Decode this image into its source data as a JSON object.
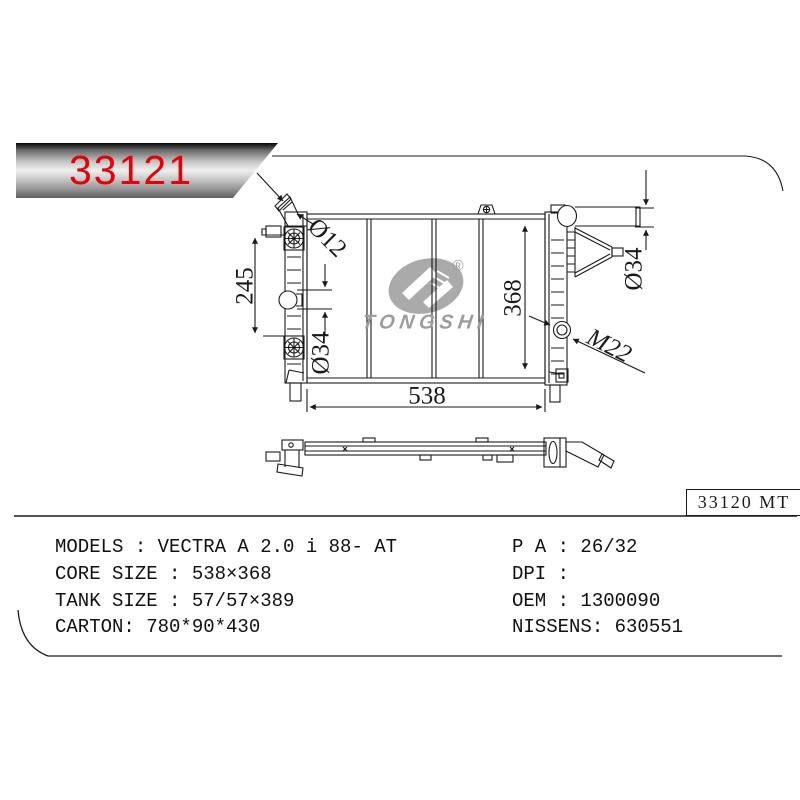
{
  "banner": {
    "part_number": "33121"
  },
  "watermark": {
    "brand": "TONGSHI",
    "registered": "®"
  },
  "drawing": {
    "labels": {
      "left_span": "245",
      "inlet_diameter": "Ø12",
      "left_port_diameter": "Ø34",
      "core_width": "538",
      "core_height": "368",
      "right_pipe_diameter": "Ø34",
      "drain_thread": "M22"
    }
  },
  "reference": {
    "code": "33120 MT"
  },
  "specs": {
    "left_column": [
      {
        "text": "MODELS : VECTRA A 2.0 i 88- AT"
      },
      {
        "text": "CORE SIZE : 538×368"
      },
      {
        "text": "TANK SIZE : 57/57×389"
      },
      {
        "text": "CARTON: 780*90*430"
      }
    ],
    "right_column": [
      {
        "text": "P A : 26/32"
      },
      {
        "text": "DPI :"
      },
      {
        "text": "OEM : 1300090"
      },
      {
        "text": "NISSENS: 630551"
      }
    ]
  },
  "colors": {
    "part_number_red": "#e60008",
    "line_art": "#1a1a1a",
    "watermark_gray": "#9c9c9c",
    "banner_metal_dark": "#050505",
    "banner_metal_light": "#efefef"
  }
}
